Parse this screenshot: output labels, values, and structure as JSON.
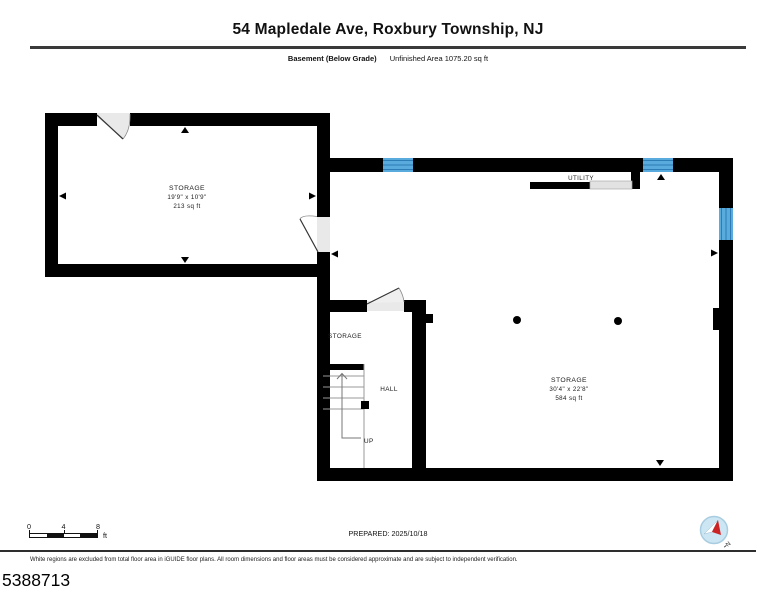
{
  "header": {
    "title": "54 Mapledale Ave, Roxbury Township, NJ",
    "floor_label": "Basement (Below Grade)",
    "area_label": "Unfinished Area 1075.20 sq ft"
  },
  "plan": {
    "rooms": {
      "storage_upper": {
        "name": "STORAGE",
        "dimensions": "19'9\" x 10'9\"",
        "area": "213 sq ft"
      },
      "storage_main": {
        "name": "STORAGE",
        "dimensions": "30'4\" x 22'8\"",
        "area": "584 sq ft"
      },
      "storage_small": {
        "name": "STORAGE"
      },
      "hall": {
        "name": "HALL"
      },
      "utility": {
        "name": "UTILITY"
      }
    },
    "stairs": {
      "direction_label": "UP"
    }
  },
  "scale_bar": {
    "ticks": [
      "0",
      "4",
      "8"
    ],
    "unit": "ft"
  },
  "footer": {
    "prepared": "PREPARED: 2025/10/18",
    "compass_north": "N",
    "disclaimer": "White regions are excluded from total floor area in iGUIDE floor plans. All room dimensions and floor areas must be considered approximate and are subject to independent verification.",
    "photo_id": "5388713"
  },
  "colors": {
    "wall": "#000000",
    "window_fill": "#58abdc",
    "window_line": "#2d7cb5",
    "door_fill": "#e9e9e9",
    "compass_fill": "#cde6f4",
    "needle_red": "#cc2424"
  }
}
